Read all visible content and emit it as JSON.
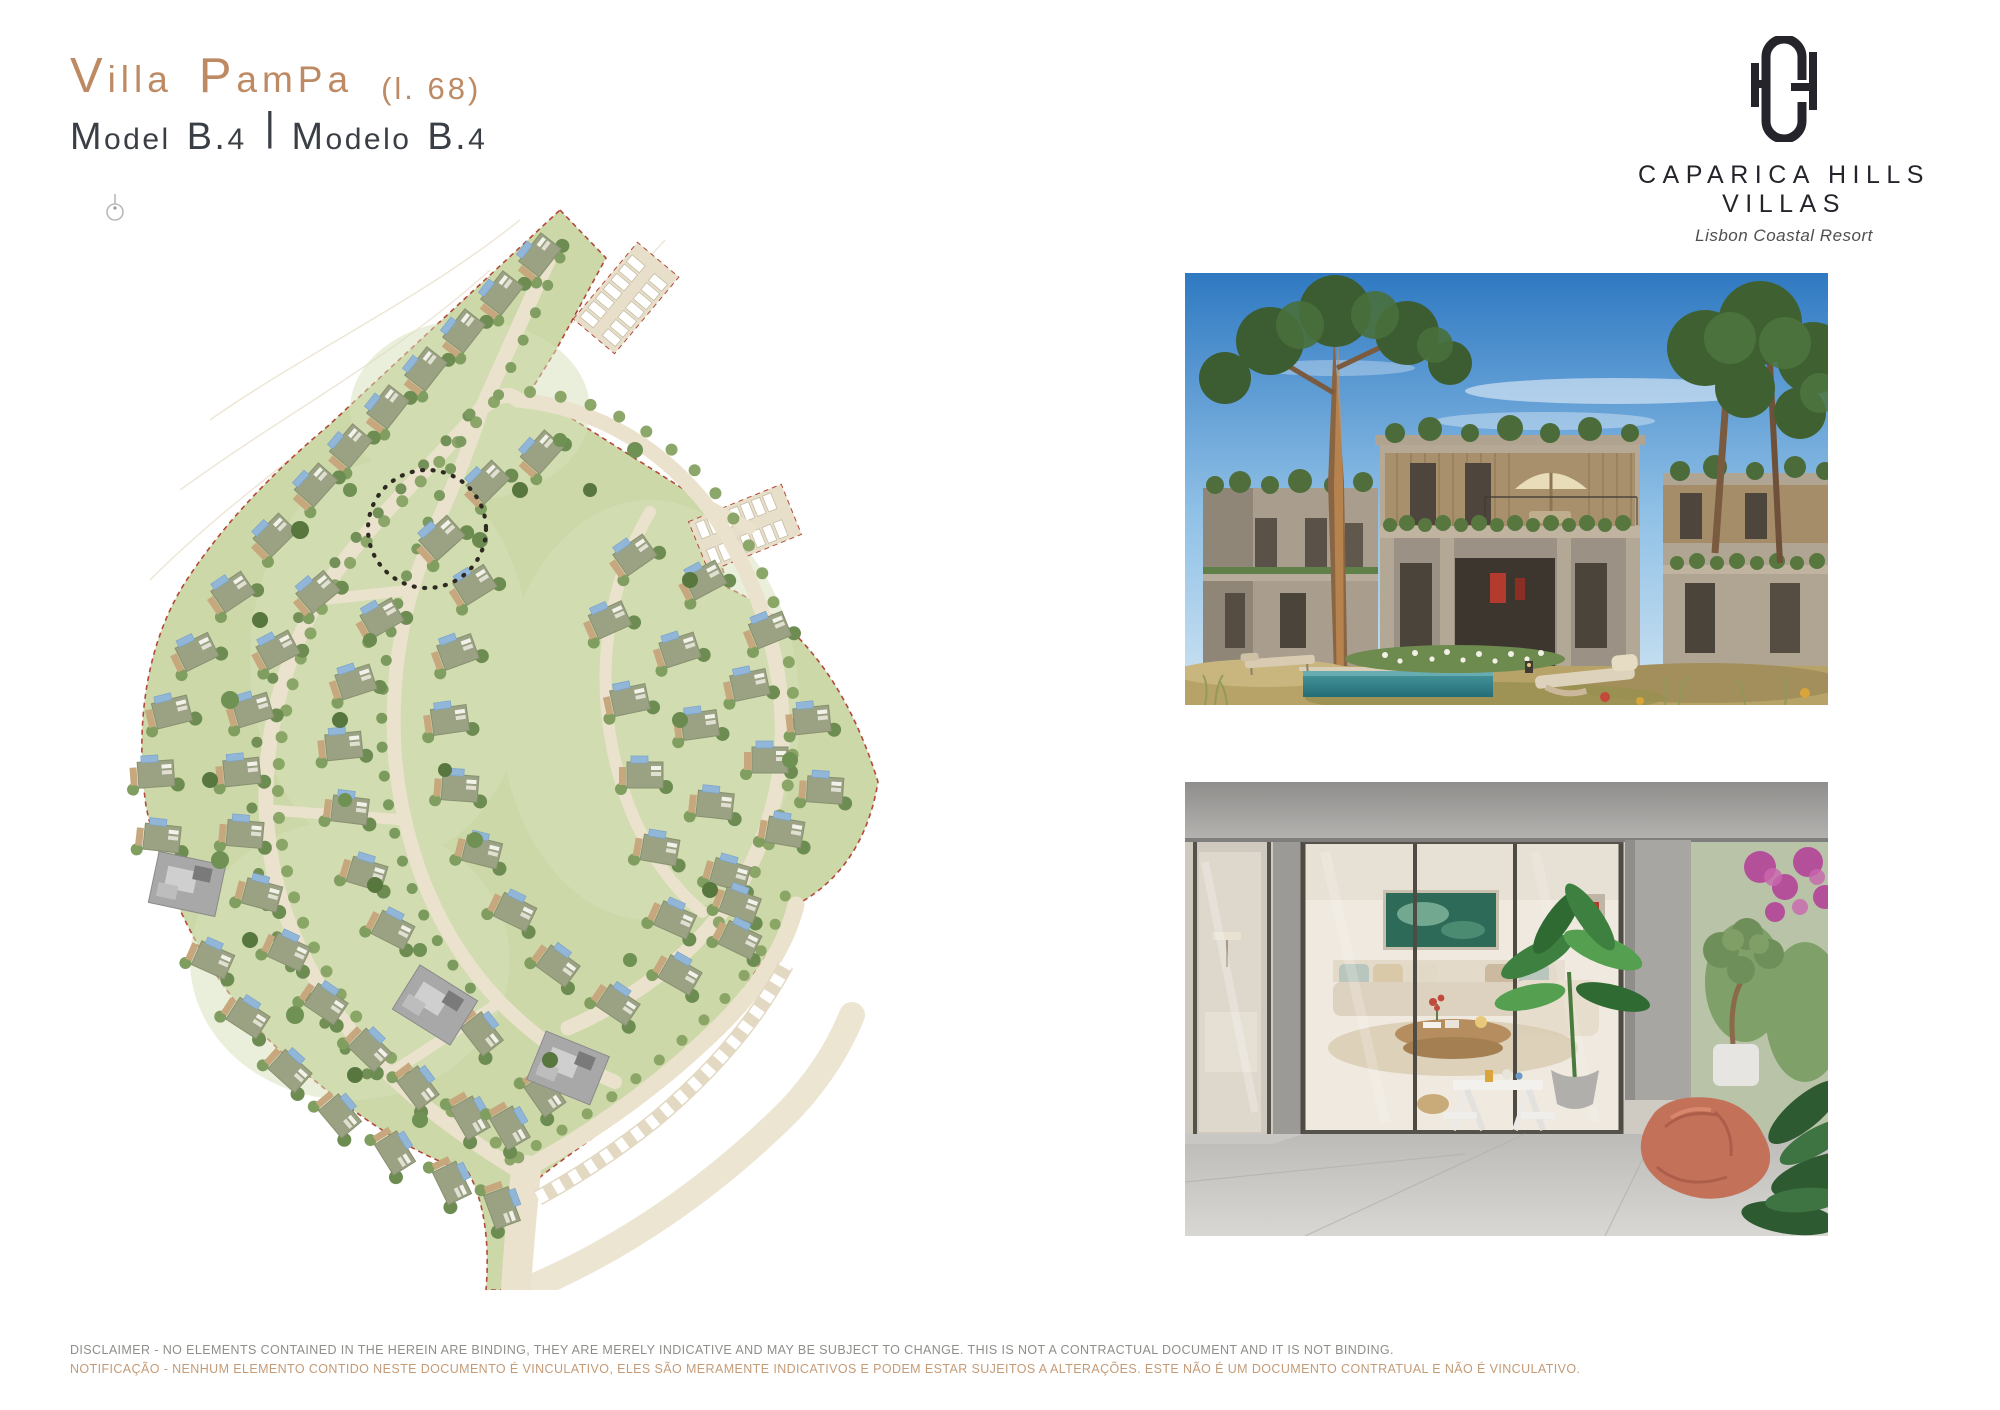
{
  "page": {
    "background": "#ffffff"
  },
  "header": {
    "title_words": [
      "Villa",
      "PamPa"
    ],
    "lot_label": "(l. 68)",
    "model_words_en": [
      "Model",
      "B.4"
    ],
    "separator": "|",
    "model_words_pt": [
      "Modelo",
      "B.4"
    ],
    "accent_color": "#bd8a63",
    "text_color": "#3a3f46"
  },
  "brand": {
    "monogram_letters": "HCH",
    "name": "CAPARICA HILLS VILLAS",
    "tagline": "Lisbon Coastal Resort",
    "color": "#26242b"
  },
  "site_plan": {
    "highlighted_lot": "68",
    "colors": {
      "lawn": "#ccd8a8",
      "road": "#eae2cd",
      "building": "#9aa283",
      "pool": "#8fb4d8",
      "tree_dark": "#5f7f48",
      "tree_mid": "#7d9b5e",
      "tan": "#c7a87e",
      "boundary_dashed": "#b3493a",
      "highlight_ring": "#2e2a22",
      "existing_building": "#a8a8a8"
    }
  },
  "disclaimer": {
    "en": "DISCLAIMER - NO ELEMENTS CONTAINED IN THE HEREIN ARE BINDING, THEY ARE MERELY INDICATIVE AND MAY BE SUBJECT TO CHANGE. THIS IS NOT A CONTRACTUAL DOCUMENT AND IT IS NOT BINDING.",
    "pt": "NOTIFICAÇÃO - NENHUM ELEMENTO CONTIDO NESTE DOCUMENTO É VINCULATIVO, ELES SÃO MERAMENTE INDICATIVOS E PODEM ESTAR SUJEITOS A ALTERAÇÕES. ESTE NÃO É UM DOCUMENTO CONTRATUAL E NÃO É VINCULATIVO.",
    "en_color": "#8f8e89",
    "pt_color": "#c49b77"
  }
}
